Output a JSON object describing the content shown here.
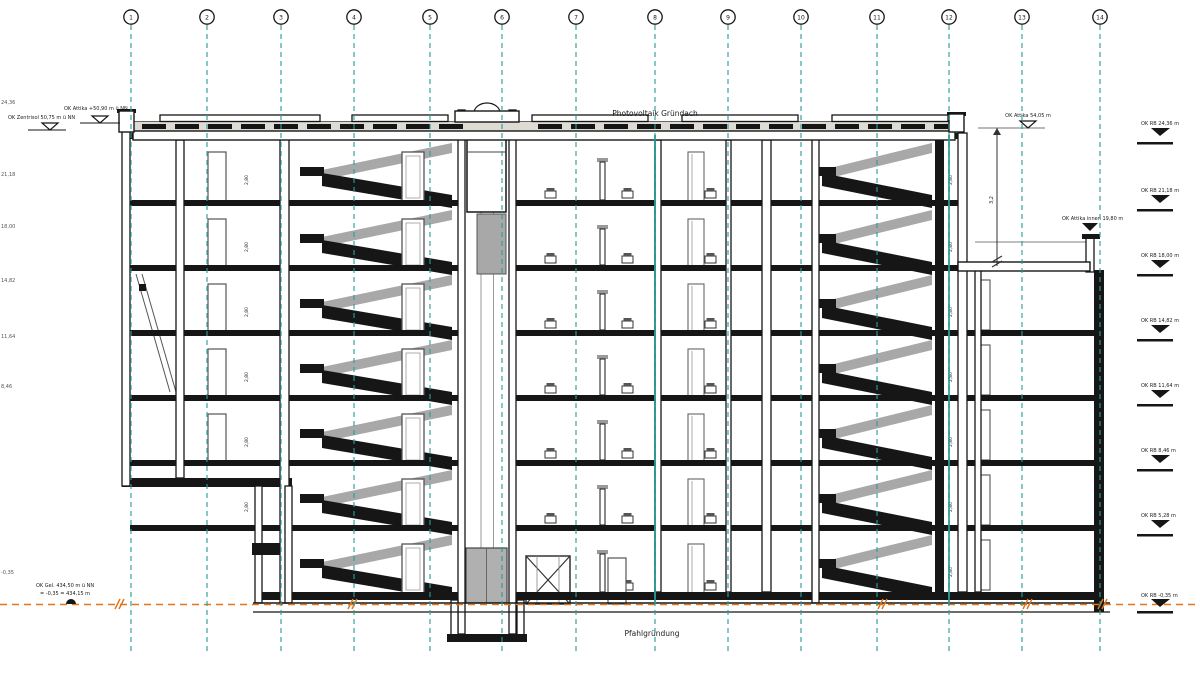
{
  "titles": {
    "roof": "Photovoltaik Gründach",
    "foundation": "Pfahlgründung"
  },
  "grid": {
    "axes": [
      "1",
      "2",
      "3",
      "4",
      "5",
      "6",
      "7",
      "8",
      "9",
      "10",
      "11",
      "12",
      "13",
      "14"
    ]
  },
  "levels": {
    "top_left_1": "OK Zentrisol 50,75 m ü NN",
    "top_left_2": "OK Attika +50,90 m ü NN",
    "top_right": "OK Attika 54,05 m",
    "mid_right": "OK Attika innen 19,80 m",
    "right": [
      "OK RB 24,36 m",
      "OK RB 21,18 m",
      "OK RB 18,00 m",
      "OK RB 14,82 m",
      "OK RB 11,64 m",
      "OK RB 8,46 m",
      "OK RB 5,28 m",
      "OK RB -0,35 m"
    ],
    "left_edge": [
      "24,36",
      "21,18",
      "18,00",
      "14,82",
      "11,64",
      "8,46",
      "-0,35"
    ],
    "bottom_left_1": "OK Gel. 434,50 m ü NN",
    "bottom_left_2": "= -0,35 = 434,15 m"
  },
  "dimensions": {
    "story_height": "2,80",
    "parapet_height": "3,2"
  },
  "colors": {
    "grid_teal": "#2a9d94",
    "ground_orange": "#e0761f",
    "line": "#1b1b1b",
    "beyond_gray": "#a8a8a8"
  }
}
